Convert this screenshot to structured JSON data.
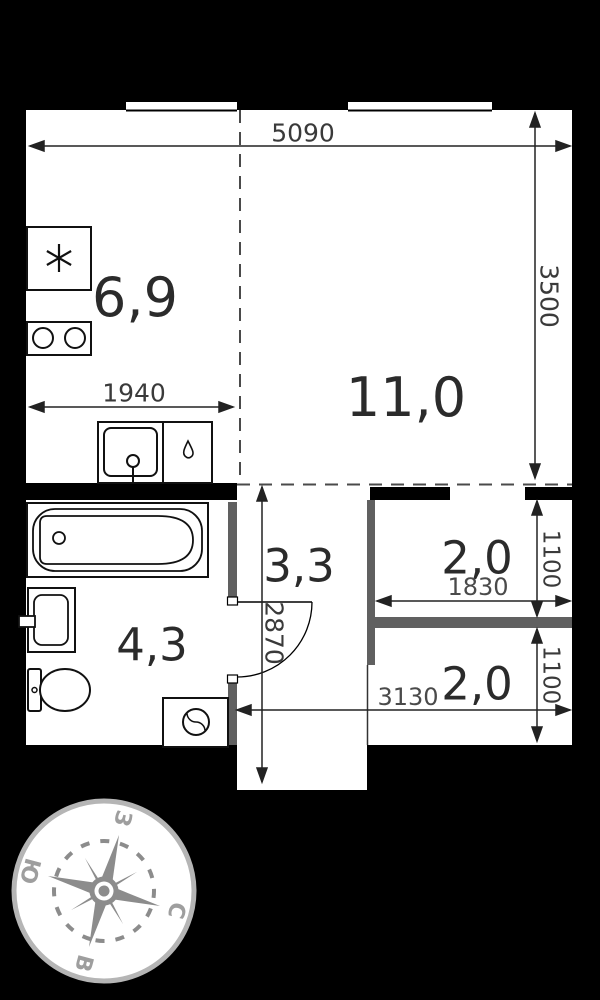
{
  "plan": {
    "title_hint": "studio apartment floor plan",
    "rooms": {
      "kitchen": {
        "area": "6,9"
      },
      "living": {
        "area": "11,0"
      },
      "hallway": {
        "area": "3,3"
      },
      "bathroom": {
        "area": "4,3"
      },
      "storage": {
        "area": "2,0"
      },
      "balcony": {
        "area": "2,0"
      }
    },
    "dimensions": {
      "overall_width": "5090",
      "living_depth": "3500",
      "kitchen_width": "1940",
      "hallway_depth": "2870",
      "storage_width": "1830",
      "storage_depth": "1100",
      "balcony_depth": "1100",
      "hallway_width": "3130"
    },
    "compass": {
      "north": "С",
      "east": "В",
      "south": "Ю",
      "west": "З"
    },
    "colors": {
      "background": "#000000",
      "floor": "#ffffff",
      "wall_black": "#000000",
      "partition_gray": "#606060",
      "compass_gray": "#8c8c8c",
      "compass_ring": "#b5b5b5"
    }
  }
}
